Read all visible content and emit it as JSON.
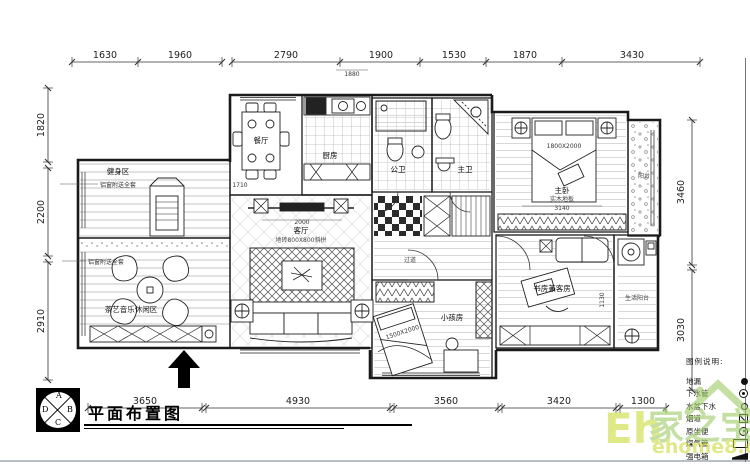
{
  "sheet": {
    "title": "平面布置图"
  },
  "title_block": {
    "quadrants": {
      "a": "A",
      "b": "B",
      "c": "C",
      "d": "D"
    }
  },
  "dims": {
    "top": [
      "1630",
      "1960",
      "2790",
      "1900",
      "1530",
      "1870",
      "3430"
    ],
    "left": [
      "1820",
      "2200",
      "2910"
    ],
    "right": [
      "3460",
      "3030"
    ],
    "bottom": [
      "3650",
      "4930",
      "3560",
      "3420",
      "1300"
    ]
  },
  "rooms": {
    "dining": "餐厅",
    "kitchen": "厨房",
    "fitness": "健身区",
    "leisure": "茶艺音乐休闲区",
    "living": "客厅",
    "living_note": "地砖800X800斜拼",
    "guest_bath": "公卫",
    "master_bath": "主卫",
    "master_bed": "主卧",
    "master_note": "实木地板",
    "study": "书房兼客房",
    "kids": "小孩房",
    "utility_balcony": "生活阳台",
    "balcony": "阳台",
    "corridor": "过道"
  },
  "annotations": {
    "kitchen_width": "1880",
    "dining_depth": "1710",
    "tv_wall": "2000",
    "master_width": "3140",
    "master_bed_size": "1800X2000",
    "kids_bed_size": "1500X2000",
    "study_dim": "1130",
    "window_note": "铝窗附送全套"
  },
  "legend": {
    "heading": "图例说明:",
    "items": [
      {
        "label": "地漏"
      },
      {
        "label": "下水管"
      },
      {
        "label": "水盆下水"
      },
      {
        "label": "烟道"
      },
      {
        "label": "原坐便"
      },
      {
        "label": "煤气管"
      },
      {
        "label": "强电箱"
      }
    ]
  },
  "watermark": {
    "brand_cn": "家之宝",
    "brand_en": "Eh",
    "site": "ehome8.com"
  }
}
